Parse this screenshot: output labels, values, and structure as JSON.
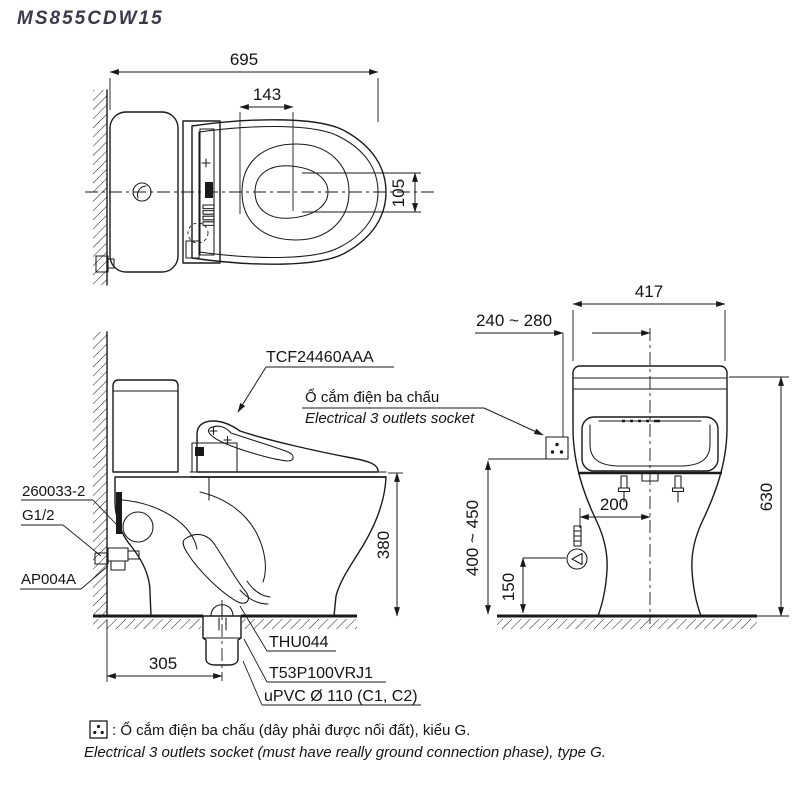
{
  "title": "MS855CDW15",
  "colors": {
    "line": "#1a1a1a",
    "title": "#3a3a4c",
    "background": "#ffffff"
  },
  "plan_view": {
    "dim_depth": "695",
    "dim_water_spot": "143",
    "dim_offset": "105"
  },
  "side_view": {
    "label_bidet_seat": "TCF24460AAA",
    "label_socket_vi": "Ổ cắm điện ba chấu",
    "label_socket_en": "Electrical 3 outlets socket",
    "label_supply_hose": "260033-2",
    "label_thread": "G1/2",
    "label_stop_valve": "AP004A",
    "label_seal": "THU044",
    "label_flange": "T53P100VRJ1",
    "label_drain_pipe": "uPVC Ø 110 (C1, C2)",
    "dim_rim_height": "380",
    "dim_rough_in": "305"
  },
  "rear_view": {
    "dim_tank_width": "417",
    "dim_socket_offset": "240 ~ 280",
    "dim_total_height": "630",
    "dim_socket_height": "400 ~ 450",
    "dim_supply_offset": "200",
    "dim_supply_height": "150"
  },
  "footer": {
    "note_vi": ": Ổ cắm điện ba chấu (dây phải được nối đất), kiểu G.",
    "note_en": "Electrical 3 outlets socket (must have really ground connection phase), type G."
  }
}
